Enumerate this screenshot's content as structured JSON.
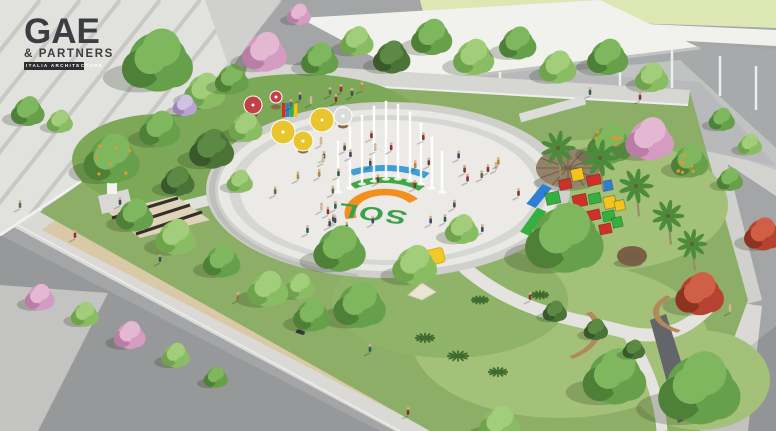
{
  "branding": {
    "logo_main": "GAE",
    "logo_sub": "& PARTNERS",
    "logo_tagline": "ITALIA ARCHITECTURE"
  },
  "plaza": {
    "ground_text": "SOL",
    "ground_text_color": "#3da04a",
    "logo_arc_blue": "#3f9fd4",
    "logo_arc_green": "#44a747",
    "logo_arc_orange": "#f2901f",
    "floor_color": "#eceae6",
    "ring_colors": [
      "#cfcfcb",
      "#e8e8e4",
      "#d6d6d2"
    ]
  },
  "palette": {
    "street": "#a4a5a7",
    "street_dark": "#97989a",
    "street_cross": "#c3c3c1",
    "sidewalk": "#dad9d6",
    "sand_path": "#d9c9a6",
    "curb_teal": "#43c3b2",
    "band_top": "#dce7b3",
    "building_face": "#e1e1de",
    "building_stripe": "#c8c9c6",
    "building_facet": "#d0d1ce",
    "roof_white": "#f1f1ee",
    "glass": "#aab1b2",
    "floor_gray": "#b8b9bb",
    "grass": "#8dae66",
    "grass_light": "#a3c178",
    "grass_dark": "#7ca858",
    "thatch": "#95826a",
    "thatch_line": "#6f5f48",
    "hut_small": "#7d5f45",
    "bench_wood": "#b08a5a",
    "pergola_dark": "#35302b",
    "statue_white": "#f2f2f0",
    "umbrella_yellow": "#e9c62f",
    "umbrella_red": "#c24048",
    "umbrella_gray": "#dcdcd8",
    "canopy_yellow": "#f2ca28",
    "tent_white": "#eae4d4",
    "water_jet": "#ffffff",
    "wall_dark": "#63656a",
    "playground": [
      "#35b03f",
      "#d03028",
      "#f2c41d",
      "#2d7fd4"
    ],
    "tree_green": [
      "#4f8038",
      "#66a04b",
      "#7fb75f"
    ],
    "tree_green_light": [
      "#6fa44c",
      "#8abc63",
      "#a2cd7a"
    ],
    "tree_green_dark": [
      "#39592b",
      "#4b7338",
      "#5c8a44"
    ],
    "tree_pink": [
      "#b97da6",
      "#d49cc0",
      "#e4b7d2"
    ],
    "tree_red": [
      "#8e3322",
      "#b5432f",
      "#cf6045"
    ],
    "tree_lilac": [
      "#9a85b8",
      "#b9a3d0",
      "#d0c2e2"
    ],
    "fruit_orange": "#e8952f",
    "trunk": "#9a8a68",
    "skin": "#d8b08c",
    "people": [
      "#7a3b2e",
      "#3b4a6b",
      "#c9b8a2",
      "#5d6d52",
      "#8c2f3a",
      "#444b52",
      "#b4893f",
      "#2e5d5a"
    ]
  }
}
